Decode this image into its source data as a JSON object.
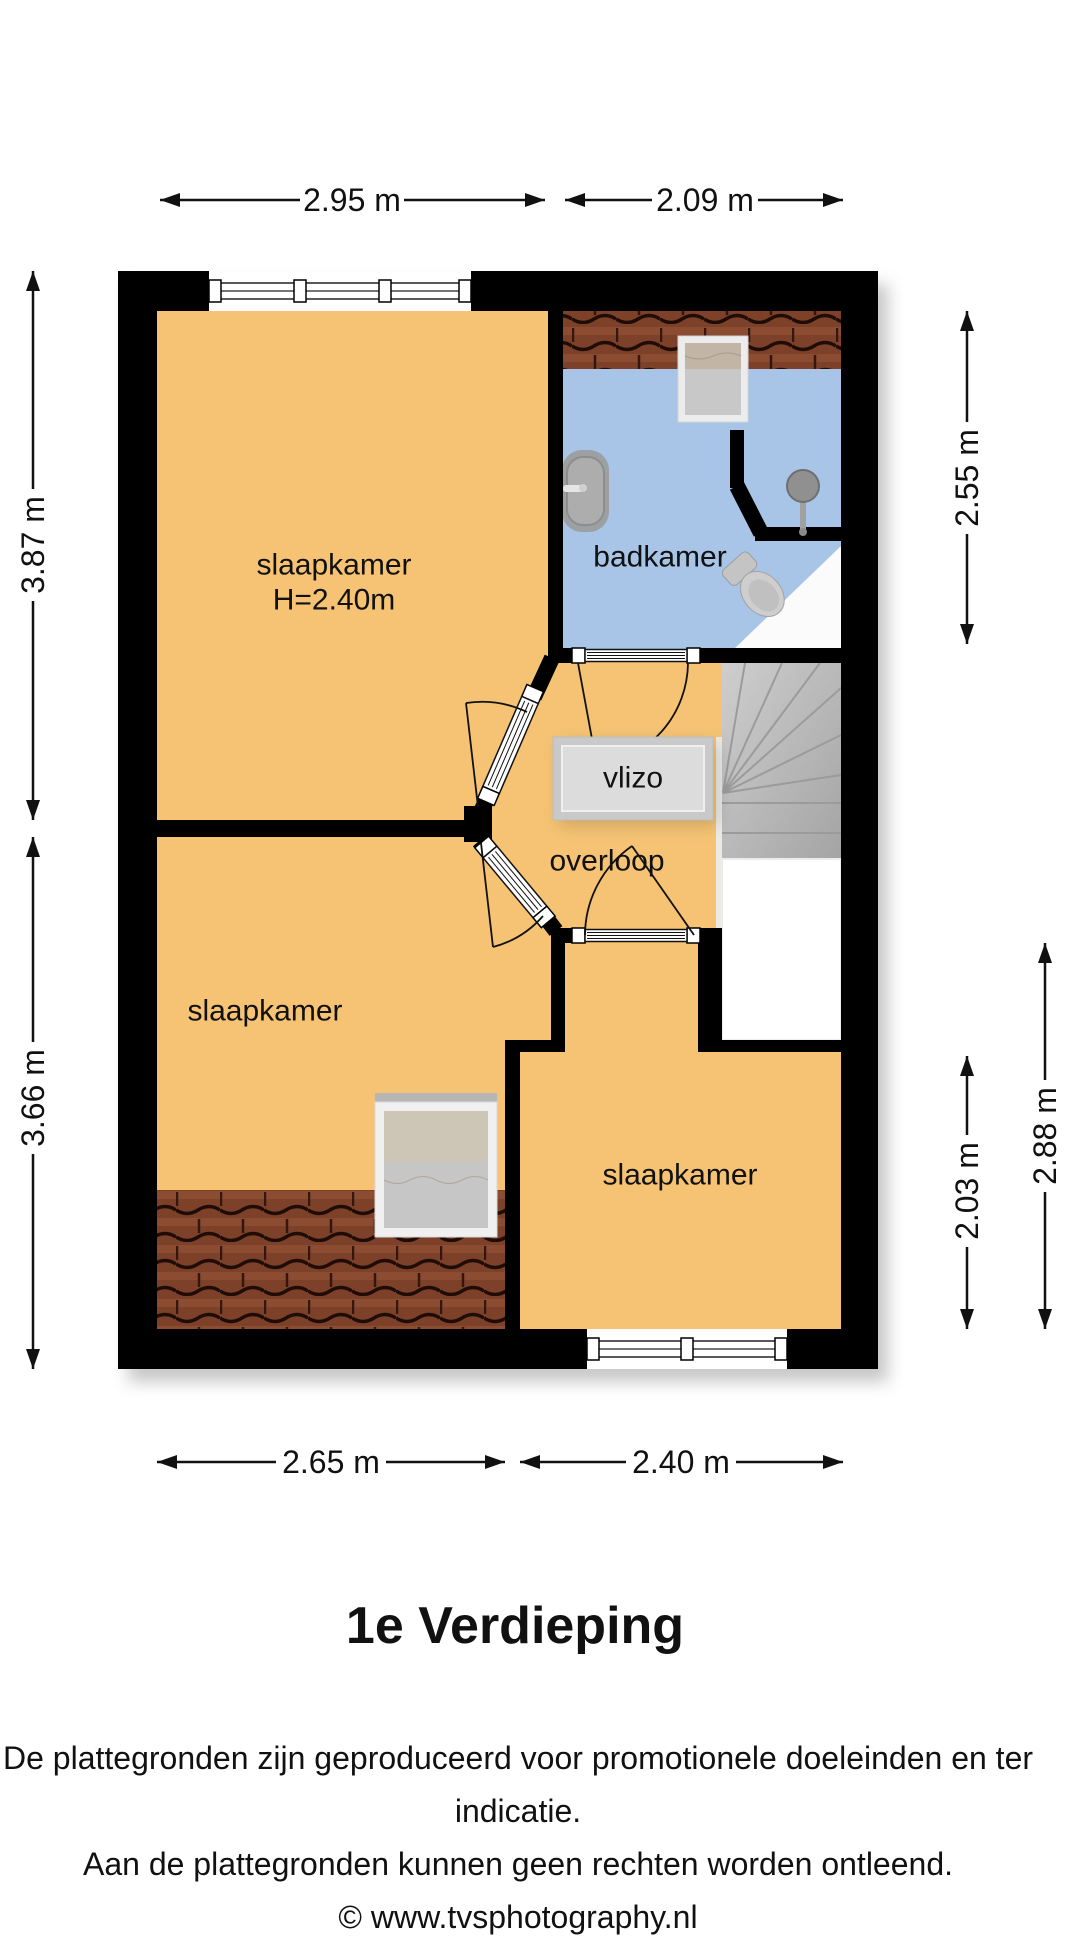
{
  "footer": {
    "title": "1e Verdieping",
    "disclaimer_1": "De plattegronden zijn geproduceerd voor promotionele doeleinden en ter indicatie.",
    "disclaimer_2": "Aan de plattegronden kunnen geen rechten worden ontleend.",
    "copyright": "© www.tvsphotography.nl"
  },
  "rooms": {
    "bedroom_top_left": {
      "label": "slaapkamer",
      "ceiling_height": "H=2.40m"
    },
    "bathroom": {
      "label": "badkamer"
    },
    "loft_hatch": {
      "label": "vlizo"
    },
    "landing": {
      "label": "overloop"
    },
    "bedroom_bottom_left": {
      "label": "slaapkamer"
    },
    "bedroom_bottom_right": {
      "label": "slaapkamer"
    }
  },
  "dimensions": {
    "top": [
      {
        "label": "2.95 m"
      },
      {
        "label": "2.09 m"
      }
    ],
    "bottom": [
      {
        "label": "2.65 m"
      },
      {
        "label": "2.40 m"
      }
    ],
    "left": [
      {
        "label": "3.87 m"
      },
      {
        "label": "3.66 m"
      }
    ],
    "right": [
      {
        "label": "2.55 m"
      },
      {
        "label": "2.88 m"
      },
      {
        "label": "2.03 m"
      }
    ]
  },
  "colors": {
    "wall": "#000000",
    "bedroom_fill": "#F5C373",
    "bathroom_fill": "#A8C5E7",
    "stairs_fill": "#b3b3b3",
    "roof_tile_fill": "#7d4129",
    "hatch_fill": "#d7d7d7"
  }
}
